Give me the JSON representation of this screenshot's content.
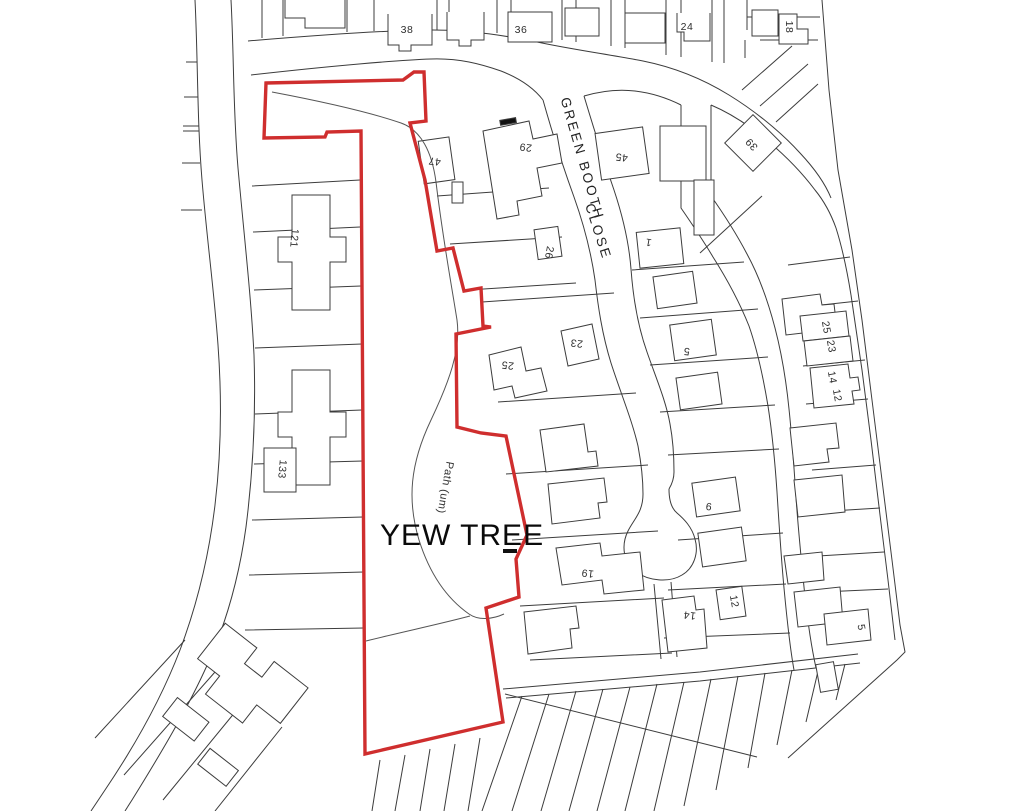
{
  "map": {
    "title": "Yew Tree site location plan",
    "site_label": "YEW TREE",
    "street_name": "GREEN BOOTH CLOSE",
    "path_label": "Path (um)",
    "colors": {
      "site_boundary": "#cf2e2e",
      "linework": "#3c3c3c",
      "pathline": "#555555",
      "background": "#ffffff"
    },
    "labels": [
      {
        "text": "38",
        "x": 407,
        "y": 33,
        "rot": 0,
        "cls": "house"
      },
      {
        "text": "36",
        "x": 521,
        "y": 33,
        "rot": 0,
        "cls": "house"
      },
      {
        "text": "24",
        "x": 687,
        "y": 30,
        "rot": 0,
        "cls": "house"
      },
      {
        "text": "18",
        "x": 786,
        "y": 27,
        "rot": 90,
        "cls": "house"
      },
      {
        "text": "47",
        "x": 435,
        "y": 158,
        "rot": 187,
        "cls": "house"
      },
      {
        "text": "29",
        "x": 526,
        "y": 144,
        "rot": 187,
        "cls": "house"
      },
      {
        "text": "45",
        "x": 622,
        "y": 154,
        "rot": 187,
        "cls": "house"
      },
      {
        "text": "39",
        "x": 754,
        "y": 142,
        "rot": 227,
        "cls": "house"
      },
      {
        "text": "26",
        "x": 546,
        "y": 252,
        "rot": 100,
        "cls": "house"
      },
      {
        "text": "1",
        "x": 649,
        "y": 239,
        "rot": 190,
        "cls": "house"
      },
      {
        "text": "25",
        "x": 508,
        "y": 362,
        "rot": 187,
        "cls": "house"
      },
      {
        "text": "23",
        "x": 577,
        "y": 340,
        "rot": 187,
        "cls": "house"
      },
      {
        "text": "5",
        "x": 687,
        "y": 348,
        "rot": 187,
        "cls": "house"
      },
      {
        "text": "25",
        "x": 823,
        "y": 328,
        "rot": 80,
        "cls": "house"
      },
      {
        "text": "23",
        "x": 828,
        "y": 347,
        "rot": 80,
        "cls": "house"
      },
      {
        "text": "14",
        "x": 829,
        "y": 378,
        "rot": 80,
        "cls": "house"
      },
      {
        "text": "12",
        "x": 834,
        "y": 396,
        "rot": 80,
        "cls": "house"
      },
      {
        "text": "9",
        "x": 709,
        "y": 503,
        "rot": 187,
        "cls": "house"
      },
      {
        "text": "19",
        "x": 588,
        "y": 570,
        "rot": 187,
        "cls": "house"
      },
      {
        "text": "14",
        "x": 690,
        "y": 612,
        "rot": 187,
        "cls": "house"
      },
      {
        "text": "12",
        "x": 731,
        "y": 602,
        "rot": 80,
        "cls": "house"
      },
      {
        "text": "5",
        "x": 858,
        "y": 628,
        "rot": 80,
        "cls": "house"
      },
      {
        "text": "121",
        "x": 291,
        "y": 238,
        "rot": 95,
        "cls": "house"
      },
      {
        "text": "133",
        "x": 279,
        "y": 469,
        "rot": 95,
        "cls": "house"
      },
      {
        "text": "Path (um)",
        "x": 442,
        "y": 487,
        "rot": 100,
        "cls": "path"
      },
      {
        "text": "GREEN BOOTH",
        "x": 578,
        "y": 160,
        "rot": 74,
        "cls": "street"
      },
      {
        "text": "CLOSE",
        "x": 594,
        "y": 233,
        "rot": 72,
        "cls": "street"
      },
      {
        "text": "YEW TREE",
        "x": 462,
        "y": 545,
        "rot": 0,
        "cls": "site"
      }
    ]
  }
}
